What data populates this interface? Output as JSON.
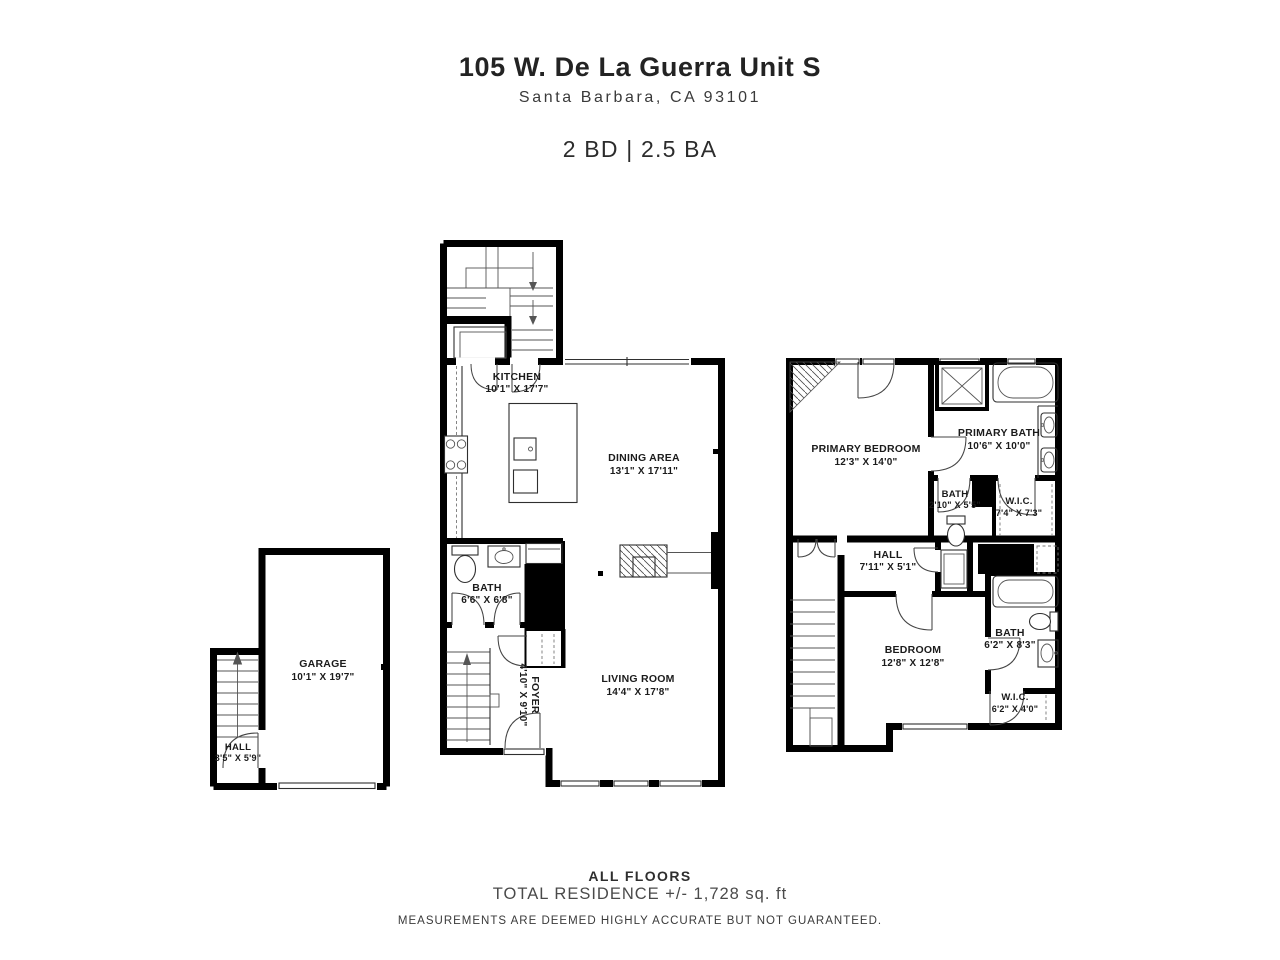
{
  "header": {
    "title": "105 W. De La Guerra Unit S",
    "subtitle": "Santa Barbara, CA 93101",
    "beds_baths": "2 BD | 2.5 BA"
  },
  "rooms": {
    "garage": {
      "name": "GARAGE",
      "dims": "10'1\" X 19'7\""
    },
    "garage_hall": {
      "name": "HALL",
      "dims": "3'5\" X 5'9\""
    },
    "kitchen": {
      "name": "KITCHEN",
      "dims": "10'1\" X 17'7\""
    },
    "dining": {
      "name": "DINING AREA",
      "dims": "13'1\" X 17'11\""
    },
    "bath_main": {
      "name": "BATH",
      "dims": "6'6\" X 6'8\""
    },
    "foyer": {
      "name": "FOYER",
      "dims": "4'10\" X 9'10\""
    },
    "living": {
      "name": "LIVING ROOM",
      "dims": "14'4\" X 17'8\""
    },
    "primary_bedroom": {
      "name": "PRIMARY BEDROOM",
      "dims": "12'3\" X 14'0\""
    },
    "primary_bath": {
      "name": "PRIMARY BATH",
      "dims": "10'6\" X 10'0\""
    },
    "bath_upper_small": {
      "name": "BATH",
      "dims": "2'10\" X 5'5\""
    },
    "wic_primary": {
      "name": "W.I.C.",
      "dims": "7'4\" X 7'3\""
    },
    "hall_upper": {
      "name": "HALL",
      "dims": "7'11\" X 5'1\""
    },
    "bedroom": {
      "name": "BEDROOM",
      "dims": "12'8\" X 12'8\""
    },
    "bath_upper": {
      "name": "BATH",
      "dims": "6'2\" X 8'3\""
    },
    "wic_bedroom": {
      "name": "W.I.C.",
      "dims": "6'2\" X 4'0\""
    }
  },
  "footer": {
    "floors_label": "ALL FLOORS",
    "total_area": "TOTAL RESIDENCE +/- 1,728 sq. ft",
    "disclaimer": "MEASUREMENTS ARE DEEMED HIGHLY ACCURATE BUT NOT GUARANTEED."
  },
  "colors": {
    "wall": "#000000",
    "background": "#ffffff",
    "text": "#1d1d1d"
  }
}
